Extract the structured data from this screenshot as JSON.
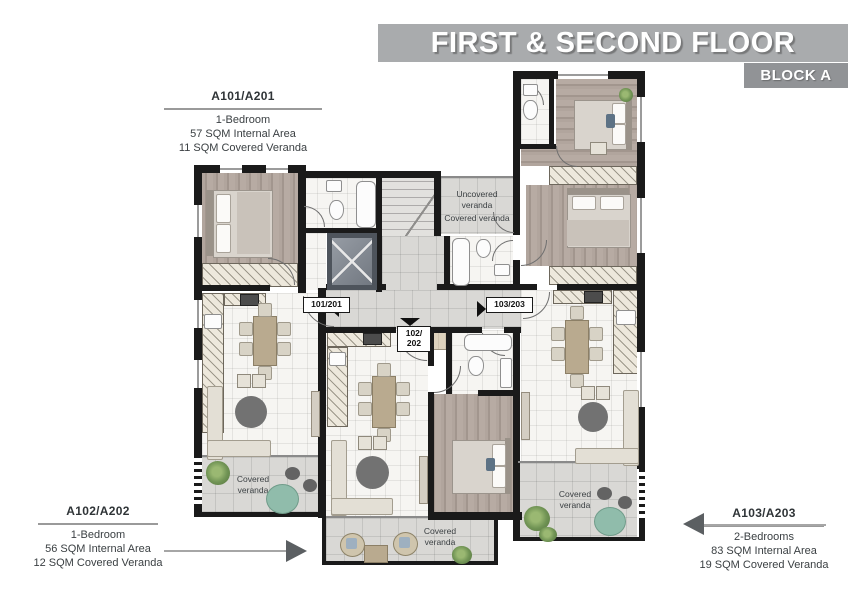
{
  "header": {
    "title": "FIRST & SECOND FLOOR",
    "block": "BLOCK A"
  },
  "callouts": {
    "a101": {
      "id": "A101/A201",
      "type": "1-Bedroom",
      "internal": "57 SQM Internal Area",
      "veranda": "11 SQM Covered Veranda"
    },
    "a102": {
      "id": "A102/A202",
      "type": "1-Bedroom",
      "internal": "56 SQM Internal Area",
      "veranda": "12 SQM Covered Veranda"
    },
    "a103": {
      "id": "A103/A203",
      "type": "2-Bedrooms",
      "internal": "83 SQM Internal Area",
      "veranda": "19 SQM Covered Veranda"
    }
  },
  "plan": {
    "doors": {
      "left": "101/201",
      "mid1": "102/",
      "mid2": "202",
      "right": "103/203"
    },
    "areas": {
      "uncovered": "Uncovered\nveranda",
      "covered_top": "Covered veranda",
      "covered_a101": "Covered\nveranda",
      "covered_a102": "Covered\nveranda",
      "covered_a103": "Covered\nveranda"
    }
  },
  "colors": {
    "banner": "#a9abad",
    "block_banner": "#919396",
    "wall": "#1a1a1a",
    "teal": "#90bcab",
    "arrow": "#5b5f62"
  }
}
